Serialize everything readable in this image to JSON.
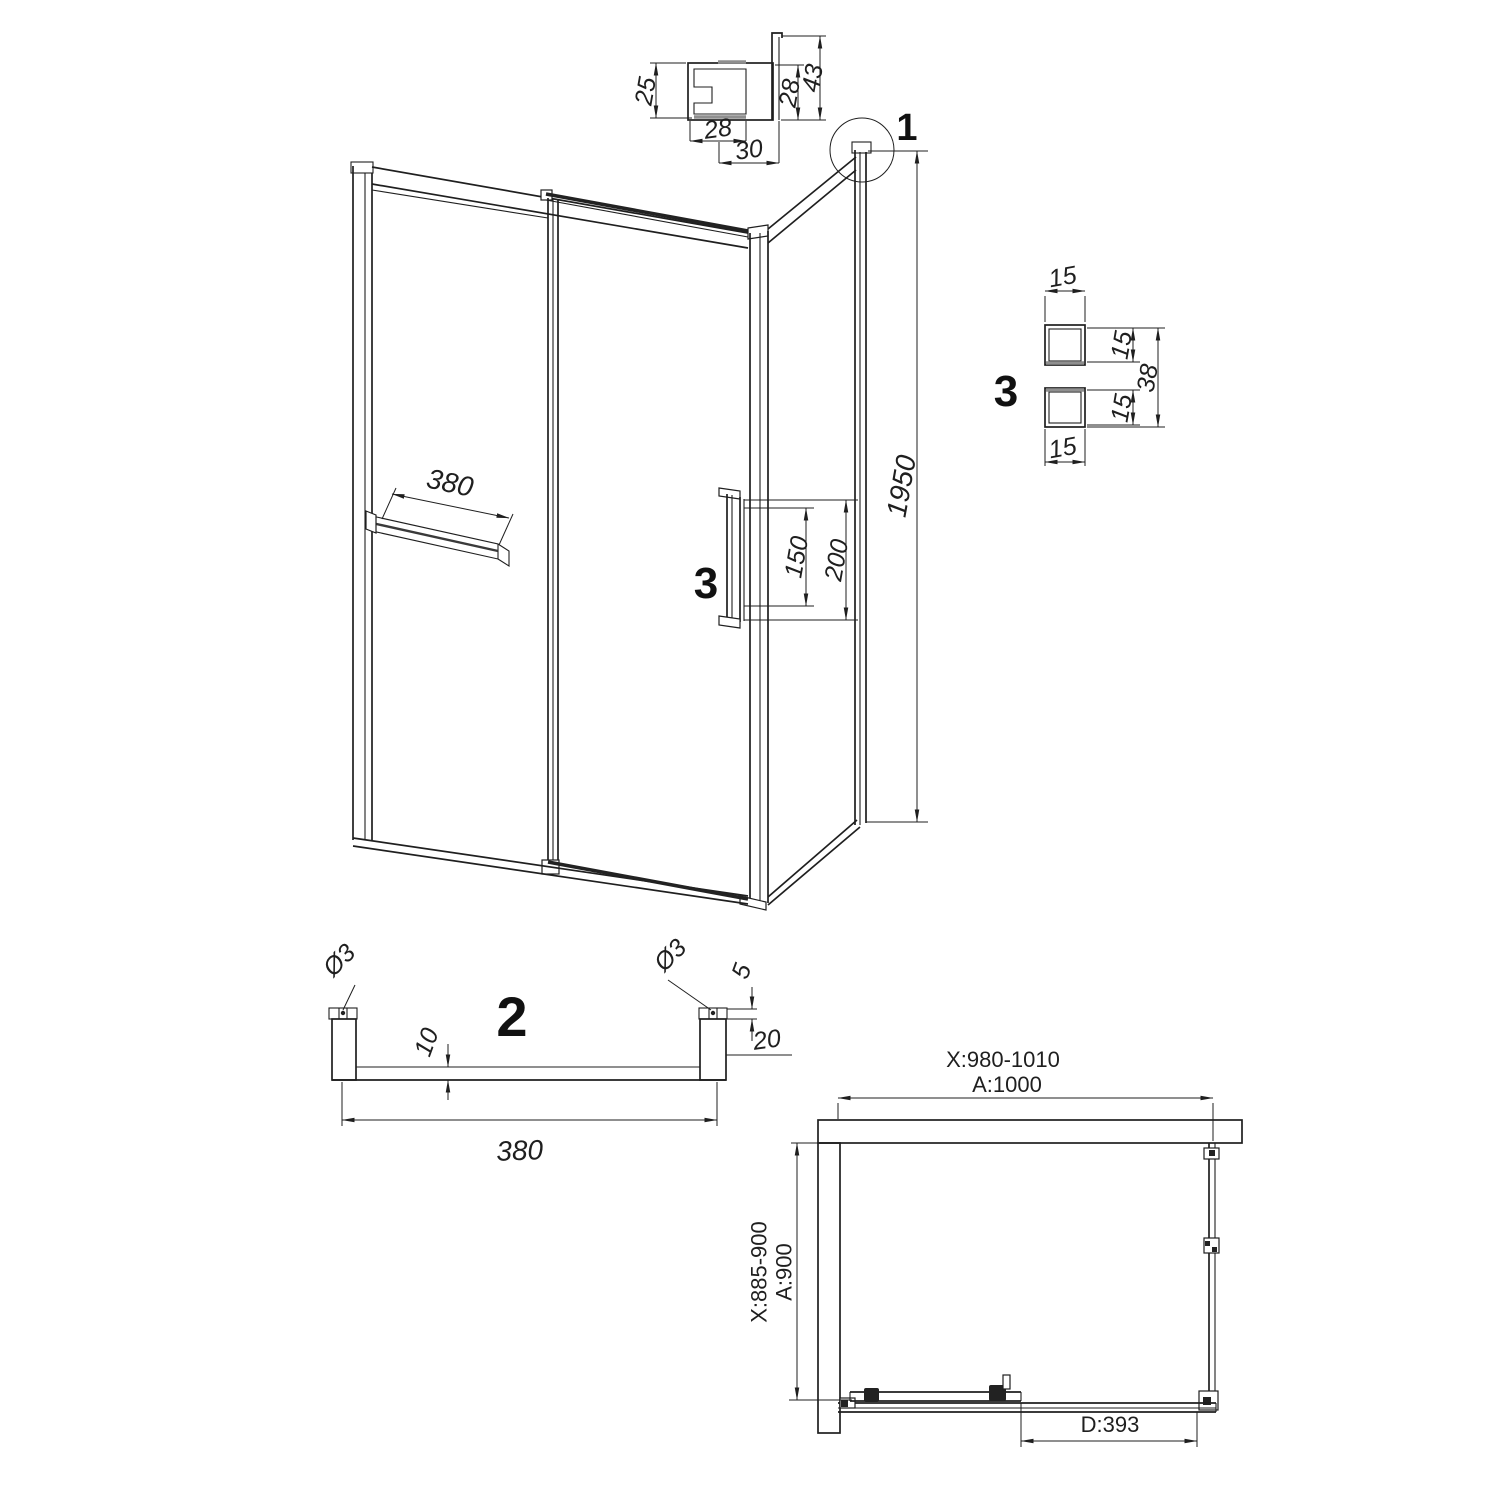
{
  "drawing": {
    "type": "shower-enclosure-technical-drawing",
    "views": [
      "wall-profile-section",
      "isometric-front-view",
      "handle-section",
      "towel-bar-section",
      "top-plan-view"
    ]
  },
  "callouts": {
    "c1": "1",
    "c2": "2",
    "c3_main": "3",
    "c3_detail": "3"
  },
  "detail1": {
    "dim_left": "25",
    "dim_inner": "28",
    "dim_outer": "43",
    "dim_bottom": "28",
    "dim_bottom2": "30"
  },
  "main_view": {
    "shelf_width": "380",
    "handle_len": "150",
    "handle_total": "200",
    "height": "1950"
  },
  "detail3": {
    "dim_top": "15",
    "dim_right_upper": "15",
    "dim_overall": "38",
    "dim_right_lower": "15",
    "dim_bottom": "15"
  },
  "detail2": {
    "dia_left": "Ø3",
    "dia_right": "Ø3",
    "dim_plate": "5",
    "dim_depth": "10",
    "dim_height": "20",
    "dim_length": "380"
  },
  "plan": {
    "width_range": "X:980-1010",
    "width": "A:1000",
    "depth_range": "X:885-900",
    "depth": "A:900",
    "door": "D:393"
  }
}
